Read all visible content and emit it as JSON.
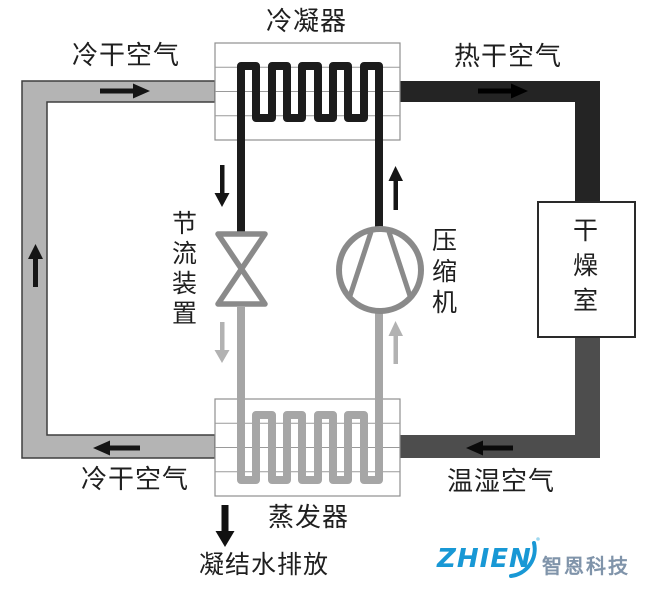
{
  "labels": {
    "condenser": "冷凝器",
    "cold_dry_air_top": "冷干空气",
    "hot_dry_air": "热干空气",
    "throttle_device": "节流装置",
    "compressor": "压缩机",
    "drying_room": "干燥室",
    "cold_dry_air_bottom": "冷干空气",
    "warm_humid_air": "温湿空气",
    "evaporator": "蒸发器",
    "condensate_discharge": "凝结水排放"
  },
  "logo": {
    "brand": "ZHIEN",
    "company": "智恩科技",
    "blue": "#1898d5",
    "gray_blue": "#8094aa"
  },
  "colors": {
    "cold_air_duct": "#b4b4b4",
    "duct_outline": "#3f3f3f",
    "hot_air_duct": "#242424",
    "humid_air_duct": "#4d4d4d",
    "condenser_coil": "#1c1c1c",
    "evaporator_coil": "#a6a6a6",
    "box_outline": "#8f8f8f",
    "drying_room_outline": "#2a2a2a",
    "symbol_outline": "#8a8a8a",
    "arrow_black": "#151515",
    "arrow_light": "#b2b2b2"
  }
}
